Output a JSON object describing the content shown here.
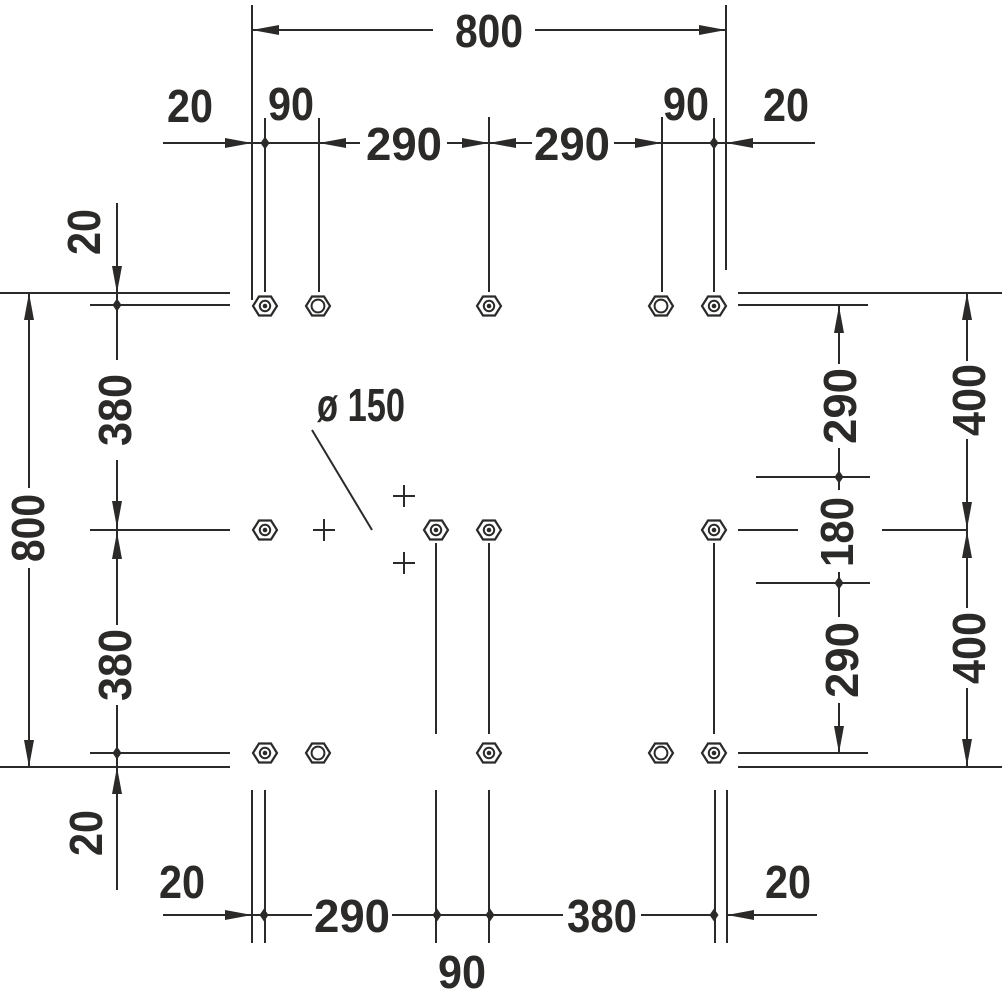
{
  "title": "Installation dimension drawing",
  "colors": {
    "line": "#2b2a29",
    "background": "#ffffff"
  },
  "symbols": {
    "fastener_filled": "hex-bolt-filled-icon",
    "fastener_open": "hex-bolt-open-icon",
    "drain_marker": "cross-marker-icon"
  },
  "dims": {
    "top": {
      "overall": "800",
      "offset_left": "20",
      "pair_left": "90",
      "mid_left": "290",
      "mid_right": "290",
      "pair_right": "90",
      "offset_right": "20"
    },
    "left": {
      "overall": "800",
      "offset_top": "20",
      "row_upper": "380",
      "row_lower": "380",
      "offset_bottom": "20"
    },
    "right": {
      "upper": "290",
      "middle": "180",
      "lower": "290",
      "half_upper": "400",
      "half_lower": "400"
    },
    "bottom": {
      "offset_left": "20",
      "span_left": "290",
      "span_center": "90",
      "span_right": "380",
      "offset_right": "20"
    },
    "drain_diameter": "ø 150"
  }
}
